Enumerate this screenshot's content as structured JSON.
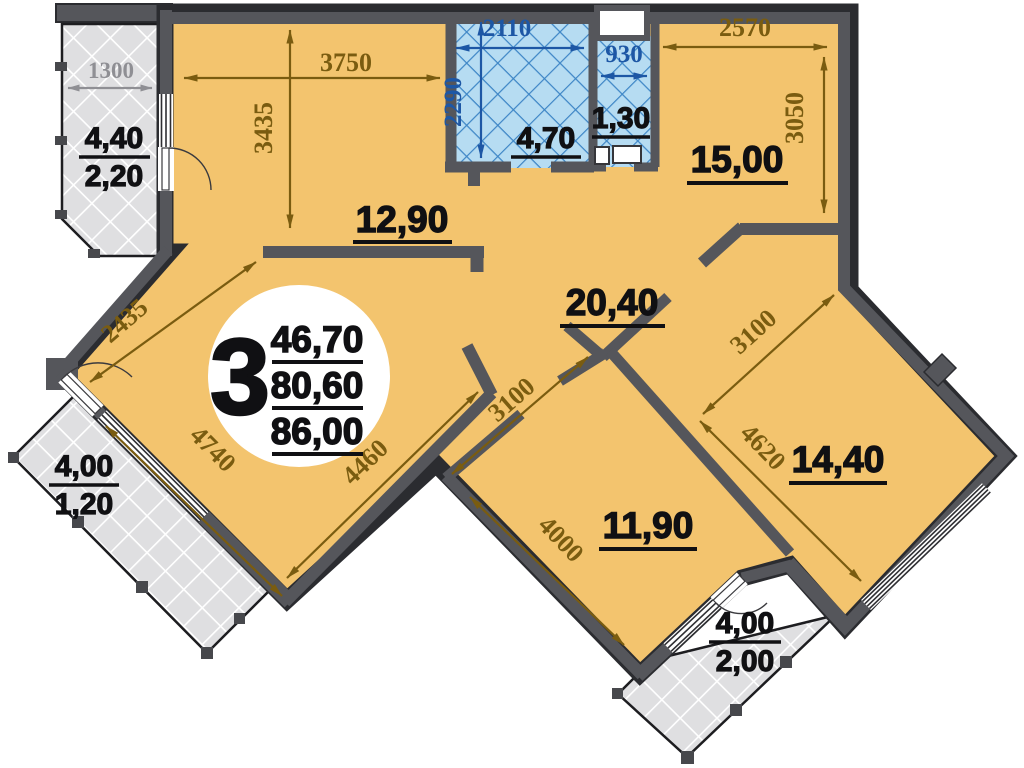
{
  "unit": {
    "rooms_count": "3",
    "area_line1": "46,70",
    "area_line2": "80,60",
    "area_line3": "86,00"
  },
  "labels": {
    "room_bedroom": "12,90",
    "room_bath": "4,70",
    "room_wc": "1,30",
    "room_kitchen": "15,00",
    "room_living": "20,40",
    "room_bottom": "11,90",
    "room_right": "14,40"
  },
  "balconies": {
    "top_left": {
      "area_full": "4,40",
      "area_reduced": "2,20",
      "dim": "1300"
    },
    "bottom_left": {
      "area_full": "4,00",
      "area_reduced": "1,20"
    },
    "bottom_center": {
      "area_full": "4,00",
      "area_reduced": "2,00"
    }
  },
  "dims": {
    "bedroom_w": "3750",
    "bedroom_h": "3435",
    "bath_w": "2110",
    "bath_h": "2290",
    "wc_w": "930",
    "kitchen_w": "2570",
    "kitchen_h": "3050",
    "living_nw": "2435",
    "living_sw": "4740",
    "living_se": "4460",
    "bottom_nw": "3100",
    "bottom_sw": "4000",
    "right_nw": "3100",
    "right_sw": "4620"
  },
  "colors": {
    "room_fill": "#f3c46e",
    "wall": "#55565b",
    "wall_edge": "#2b2c30",
    "dim_olive": "#7a5c10",
    "dim_blue": "#1d57a5",
    "wet_fill": "#b6dcf2",
    "wet_line": "#3e86c6",
    "balcony_fill": "#dfdfe1",
    "dim_gray": "#8f8f94",
    "label": "#101013"
  }
}
